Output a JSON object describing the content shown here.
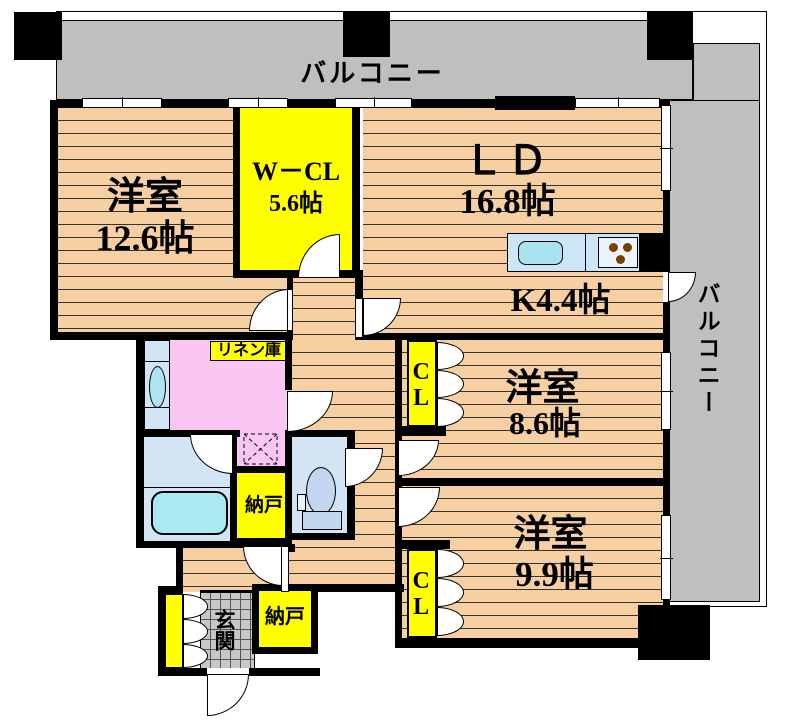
{
  "plan": {
    "balcony_top": "バルコニー",
    "balcony_right": "バルコニー",
    "rooms": {
      "bedroom1": {
        "name": "洋室",
        "size": "12.6帖"
      },
      "wcl": {
        "name": "W－CL",
        "size": "5.6帖"
      },
      "living": {
        "name": "ＬＤ",
        "size": "16.8帖"
      },
      "kitchen": {
        "label": "K4.4帖"
      },
      "bedroom2": {
        "name": "洋室",
        "size": "8.6帖"
      },
      "bedroom3": {
        "name": "洋室",
        "size": "9.9帖"
      }
    },
    "closets": {
      "cl1": "CL",
      "cl2": "CL"
    },
    "labels": {
      "linen": "リネン庫",
      "storage1": "納戸",
      "storage2": "納戸",
      "entrance": "玄関"
    }
  },
  "colors": {
    "floor_wood": "#F6CFA2",
    "closet_yellow": "#FFFF00",
    "washroom_pink": "#F9C7F2",
    "bath_blue": "#D3E4F5",
    "tub_cyan": "#A9EAF2",
    "counter_blue": "#CDE6F7",
    "balcony_gray": "#BFBFBF",
    "wall_black": "#000000",
    "burner_brown": "#7B3F00"
  }
}
